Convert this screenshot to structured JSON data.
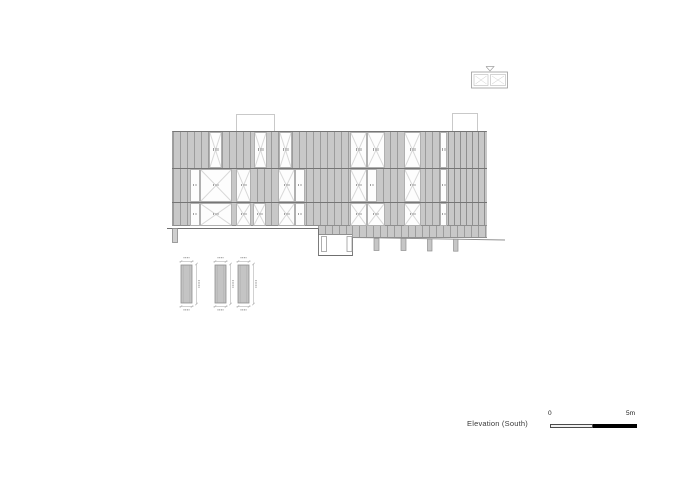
{
  "canvas": {
    "w": 700,
    "h": 498,
    "bg": "#ffffff"
  },
  "title": {
    "text": "Elevation (South)",
    "x": 467,
    "y": 419,
    "size": 7.5,
    "color": "#3a3a3a"
  },
  "scale_bar": {
    "labels": {
      "start": "0",
      "end": "5m"
    },
    "label_size": 6.5,
    "label_color": "#1a1a1a",
    "start_label_pos": {
      "x": 548,
      "y": 410
    },
    "end_label_pos": {
      "x": 626,
      "y": 410
    },
    "light_segment": {
      "x": 550,
      "y": 424,
      "w": 43,
      "h": 3.5,
      "fill": "#f1f1f1",
      "border": "#4a4a4a"
    },
    "dark_segment": {
      "x": 593,
      "y": 423.5,
      "w": 44,
      "h": 4.5,
      "fill": "#000000"
    }
  },
  "colors": {
    "clad_fill": "#c8c8c8",
    "clad_joint": "#9c9c9c",
    "dense_joint": "#8f8f8f",
    "edge_line": "#757575",
    "window_fill": "#fdfdfd",
    "window_border": "#b0b0b0",
    "cross_line": "#d8d8d8",
    "tag_mark": "#a0a0a0",
    "ground_line": "#6f6f6f",
    "slope_line": "#8f8f8f",
    "light_line": "#c9c9c9",
    "detail_fill": "#c4c4c4",
    "detail_stroke": "#8f8f8f",
    "dim_line": "#b2b2b2"
  },
  "elevation": {
    "facade": {
      "x": 172,
      "y": 131,
      "w": 315,
      "h": 95,
      "joint_spacing": 7,
      "dividers": [
        168,
        202
      ],
      "dense_right": {
        "x": 448,
        "w": 39,
        "spacing": 6
      },
      "extensions": [
        {
          "x": 318,
          "y": 226,
          "w": 34,
          "h": 9
        },
        {
          "x": 352,
          "y": 226,
          "w": 135,
          "h": 12
        }
      ]
    },
    "bands": [
      {
        "y": 131,
        "h": 37
      },
      {
        "y": 168,
        "h": 34
      },
      {
        "y": 202,
        "h": 24
      }
    ],
    "windows": [
      {
        "x": 209,
        "w": 13,
        "band": 0,
        "cross": true
      },
      {
        "x": 254,
        "w": 13,
        "band": 0,
        "cross": true
      },
      {
        "x": 279,
        "w": 13,
        "band": 0,
        "cross": true
      },
      {
        "x": 350,
        "w": 17,
        "band": 0,
        "cross": true
      },
      {
        "x": 367,
        "w": 18,
        "band": 0,
        "cross": true
      },
      {
        "x": 404,
        "w": 17,
        "band": 0,
        "cross": true
      },
      {
        "x": 440,
        "w": 7,
        "band": 0,
        "cross": false
      },
      {
        "x": 190,
        "w": 10,
        "band": 1,
        "cross": false
      },
      {
        "x": 200,
        "w": 32,
        "band": 1,
        "cross": true
      },
      {
        "x": 236,
        "w": 15,
        "band": 1,
        "cross": true
      },
      {
        "x": 278,
        "w": 17,
        "band": 1,
        "cross": true
      },
      {
        "x": 295,
        "w": 10,
        "band": 1,
        "cross": false
      },
      {
        "x": 350,
        "w": 17,
        "band": 1,
        "cross": true
      },
      {
        "x": 367,
        "w": 10,
        "band": 1,
        "cross": false
      },
      {
        "x": 404,
        "w": 17,
        "band": 1,
        "cross": true
      },
      {
        "x": 440,
        "w": 7,
        "band": 1,
        "cross": false
      },
      {
        "x": 190,
        "w": 10,
        "band": 2,
        "cross": false
      },
      {
        "x": 200,
        "w": 32,
        "band": 2,
        "cross": true
      },
      {
        "x": 236,
        "w": 15,
        "band": 2,
        "cross": true
      },
      {
        "x": 253,
        "w": 13,
        "band": 2,
        "cross": true
      },
      {
        "x": 278,
        "w": 17,
        "band": 2,
        "cross": true
      },
      {
        "x": 295,
        "w": 10,
        "band": 2,
        "cross": false
      },
      {
        "x": 350,
        "w": 17,
        "band": 2,
        "cross": true
      },
      {
        "x": 367,
        "w": 18,
        "band": 2,
        "cross": true
      },
      {
        "x": 404,
        "w": 17,
        "band": 2,
        "cross": true
      },
      {
        "x": 440,
        "w": 7,
        "band": 2,
        "cross": false
      }
    ],
    "roof_units": [
      {
        "x": 236,
        "y": 114,
        "w": 39,
        "h": 17
      },
      {
        "x": 452,
        "y": 113,
        "w": 26,
        "h": 18
      }
    ]
  },
  "ground": {
    "lines": [
      [
        167,
        228.5,
        318.5,
        228.5,
        "#6f6f6f",
        1
      ],
      [
        352.5,
        237.5,
        505,
        240,
        "#8f8f8f",
        0.9
      ]
    ],
    "polylines": [
      {
        "pts": [
          [
            318.5,
            228.5
          ],
          [
            318.5,
            255.5
          ],
          [
            352.5,
            255.5
          ],
          [
            352.5,
            237.5
          ]
        ],
        "stroke": "#6f6f6f",
        "w": 0.9
      }
    ],
    "rects": [
      [
        172.5,
        228.5,
        5,
        14,
        "#cfcfcf",
        "#8a8a8a",
        0.8
      ],
      [
        321.5,
        236.5,
        5,
        15,
        "#ffffff",
        "#9a9a9a",
        0.8
      ],
      [
        347,
        236.5,
        5,
        15,
        "#ffffff",
        "#9a9a9a",
        0.8
      ],
      [
        374,
        238.5,
        5,
        12,
        "#c6c6c6",
        "#8f8f8f",
        0.7
      ],
      [
        401,
        238.5,
        5,
        12,
        "#c6c6c6",
        "#8f8f8f",
        0.7
      ],
      [
        427.5,
        239,
        4.5,
        12,
        "#c6c6c6",
        "#8f8f8f",
        0.7
      ],
      [
        453.5,
        239.2,
        4.5,
        12,
        "#c6c6c6",
        "#8f8f8f",
        0.7
      ]
    ]
  },
  "panel_details": {
    "items": [
      {
        "x": 181
      },
      {
        "x": 215
      },
      {
        "x": 238
      }
    ],
    "y": 265,
    "w": 11,
    "h": 38
  },
  "key_plan": {
    "x": 471.5,
    "y": 72,
    "w": 36,
    "h": 16,
    "stroke": "#9a9a9a",
    "room_stroke": "#b8b8b8",
    "rooms": [
      [
        474,
        74.5,
        14,
        11
      ],
      [
        490.5,
        74.5,
        15,
        11
      ]
    ],
    "arrow": [
      [
        486,
        66.5
      ],
      [
        494,
        66.5
      ],
      [
        490,
        71
      ]
    ]
  }
}
